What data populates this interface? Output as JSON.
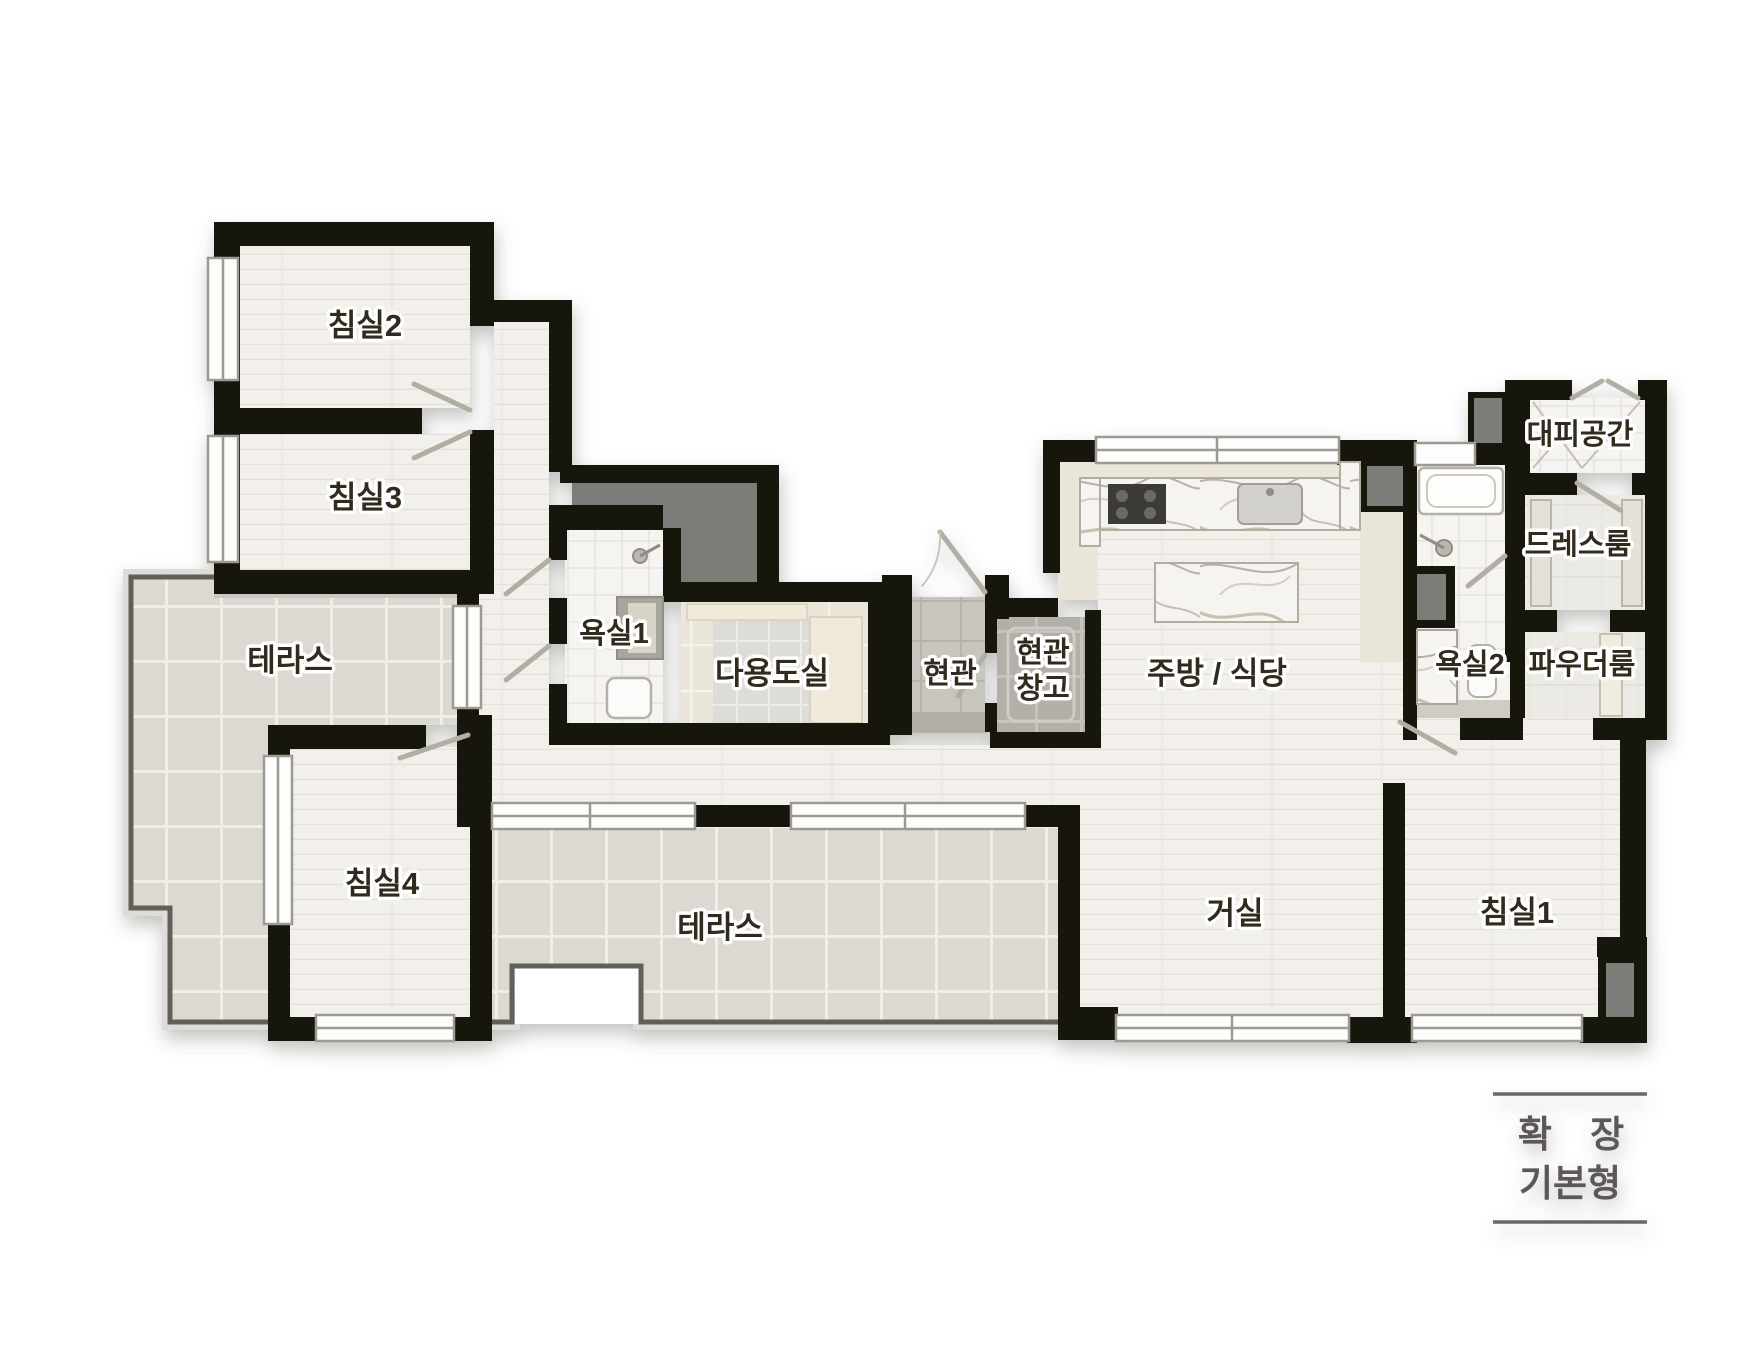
{
  "plan": {
    "rooms": [
      {
        "id": "bedroom2",
        "label": "침실2"
      },
      {
        "id": "bedroom3",
        "label": "침실3"
      },
      {
        "id": "terrace-left",
        "label": "테라스"
      },
      {
        "id": "bathroom1",
        "label": "욕실1"
      },
      {
        "id": "utility-room",
        "label": "다용도실"
      },
      {
        "id": "entrance",
        "label": "현관"
      },
      {
        "id": "entrance-storage",
        "lines": [
          "현관",
          "창고"
        ]
      },
      {
        "id": "kitchen-dining",
        "label": "주방 / 식당"
      },
      {
        "id": "bathroom2",
        "label": "욕실2"
      },
      {
        "id": "powder-room",
        "label": "파우더룸"
      },
      {
        "id": "dress-room",
        "label": "드레스룸"
      },
      {
        "id": "shelter",
        "label": "대피공간"
      },
      {
        "id": "bedroom4",
        "label": "침실4"
      },
      {
        "id": "terrace-bottom",
        "label": "테라스"
      },
      {
        "id": "living-room",
        "label": "거실"
      },
      {
        "id": "bedroom1",
        "label": "침실1"
      }
    ],
    "caption": {
      "line1": "확 장",
      "line2": "기본형"
    },
    "colors": {
      "wall": "#17140f",
      "wood_floor": "#f1f0ea",
      "terrace_tile": "#dcd9d2",
      "bath_tile": "#f5f4f1",
      "beige_floor": "#eae6da",
      "entrance_tile": "#c8c5be",
      "duct_grey": "#7b7b78",
      "label_text": "#33291f",
      "caption_text": "#5d5858"
    }
  }
}
